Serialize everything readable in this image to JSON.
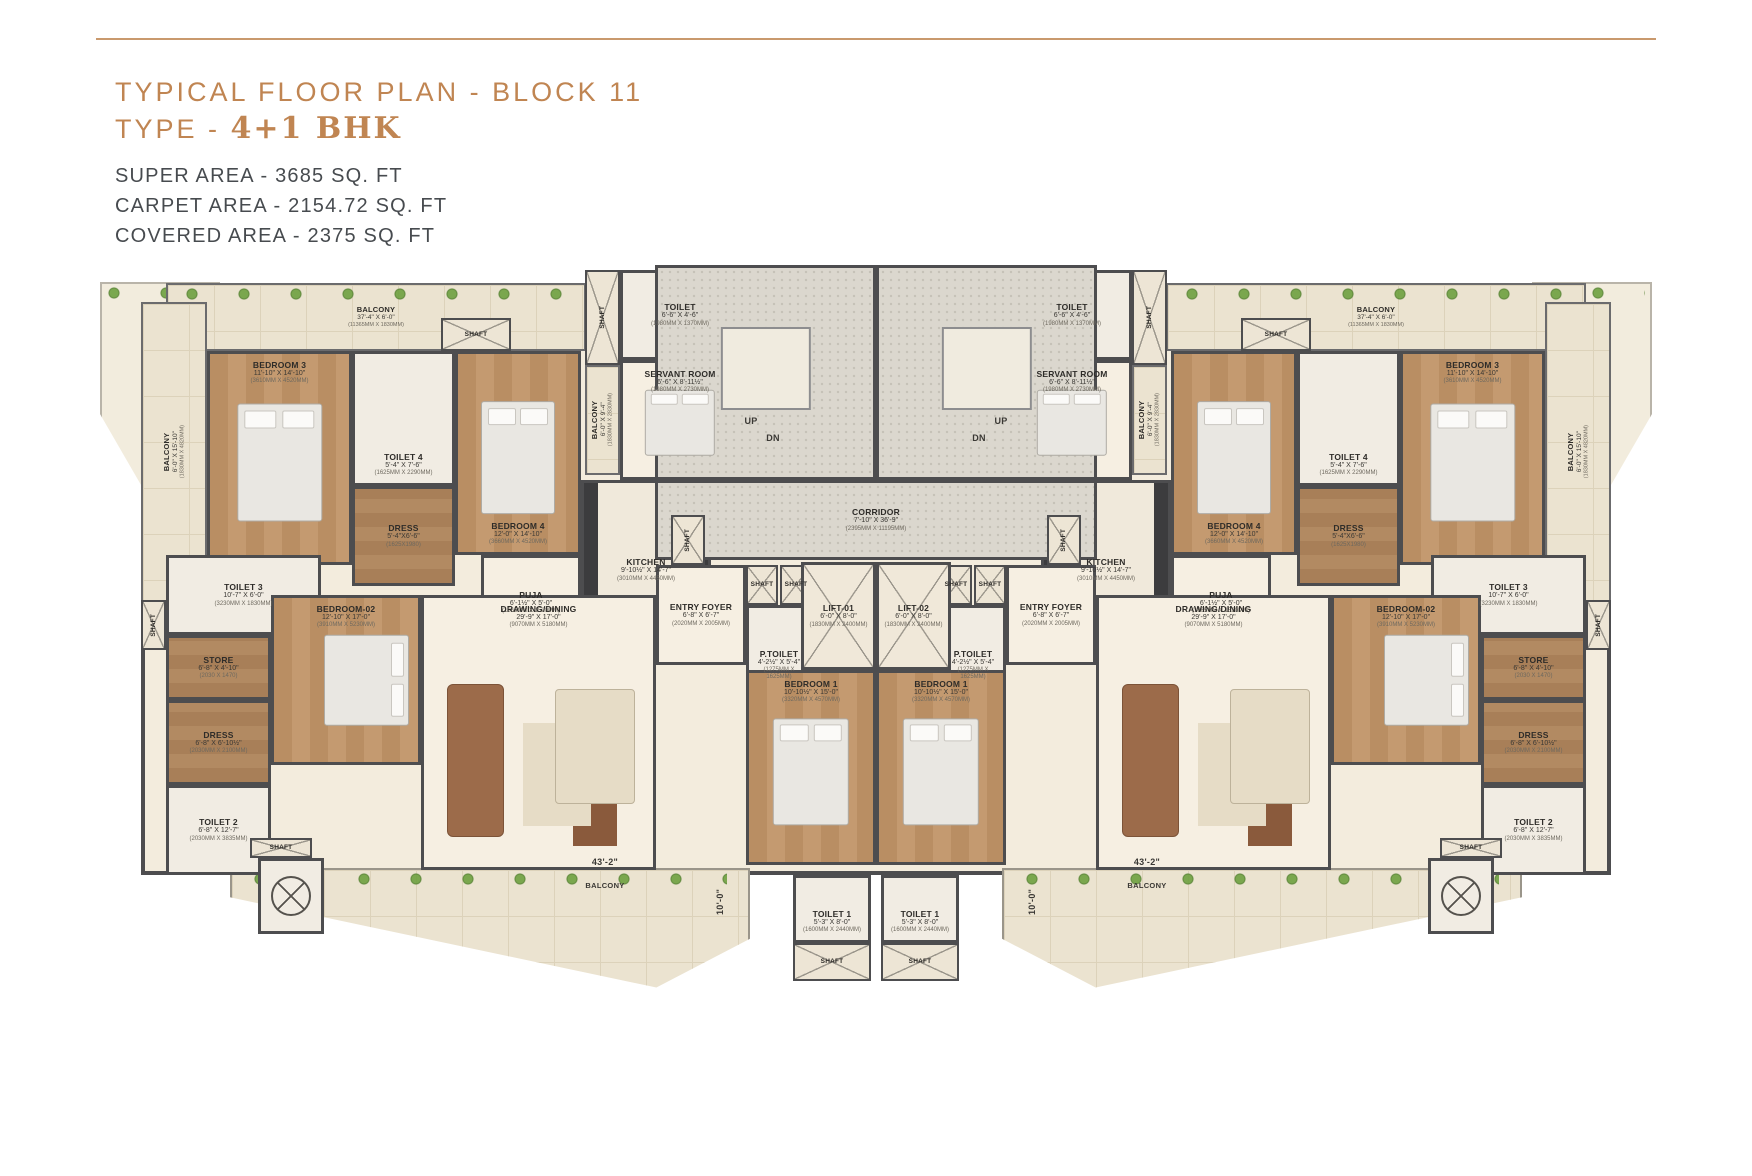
{
  "header": {
    "title": "TYPICAL FLOOR PLAN - BLOCK 11",
    "type_prefix": "TYPE - ",
    "type_value": "4+1 BHK",
    "super_area": "SUPER AREA - 3685 SQ. FT",
    "carpet_area": "CARPET AREA - 2154.72 SQ. FT",
    "covered_area": "COVERED AREA - 2375 SQ. FT",
    "accent_color": "#c08552"
  },
  "plan": {
    "wall_color": "#4d4d4f",
    "mirror_width": 1752,
    "clips": {
      "tl": [
        [
          0,
          0
        ],
        [
          100,
          0
        ],
        [
          100,
          100
        ],
        [
          52,
          100
        ],
        [
          0,
          55
        ]
      ],
      "bb": [
        [
          0,
          0
        ],
        [
          100,
          0
        ],
        [
          100,
          58
        ],
        [
          82,
          98
        ],
        [
          0,
          24
        ]
      ]
    },
    "rooms": [
      {
        "id": "base",
        "cls": "base",
        "x": 141,
        "y": 283,
        "w": 1470,
        "h": 592,
        "wing": "center"
      },
      {
        "id": "terrace",
        "cls": "terrace",
        "x": 100,
        "y": 282,
        "w": 120,
        "h": 240,
        "wing": "both",
        "clip": "tl",
        "furn": "plantrow"
      },
      {
        "id": "balcony-bottom",
        "cls": "bbal",
        "x": 230,
        "y": 868,
        "w": 520,
        "h": 122,
        "wing": "both",
        "clip": "bb",
        "furn": "plantrow"
      },
      {
        "id": "balcony-top",
        "cls": "balc",
        "name": "BALCONY",
        "dim": "37'-4\" X 6'-0\"",
        "mm": "(11365MM X 1830MM)",
        "x": 166,
        "y": 283,
        "w": 420,
        "h": 68,
        "wing": "both",
        "furn": "plantrow"
      },
      {
        "id": "balcony-side",
        "cls": "balc",
        "name": "BALCONY",
        "dim": "6'-0\" X 15'-10\"",
        "mm": "(1830MM X 4820MM)",
        "x": 141,
        "y": 302,
        "w": 66,
        "h": 300,
        "wing": "both",
        "vert": true
      },
      {
        "id": "bedroom-3",
        "cls": "bed",
        "name": "BEDROOM 3",
        "dim": "11'-10\" X 14'-10\"",
        "mm": "(3610MM X 4520MM)",
        "x": 207,
        "y": 351,
        "w": 145,
        "h": 214,
        "wing": "both",
        "lp": "t",
        "furn": "bedv"
      },
      {
        "id": "toilet-4",
        "cls": "bath",
        "name": "TOILET 4",
        "dim": "5'-4\" X 7'-6\"",
        "mm": "(1625MM X 2290MM)",
        "x": 352,
        "y": 351,
        "w": 103,
        "h": 135,
        "wing": "both",
        "lp": "b"
      },
      {
        "id": "dress-4",
        "cls": "wood",
        "name": "DRESS",
        "dim": "5'-4\"X6'-6\"",
        "mm": "(1625X1980)",
        "x": 352,
        "y": 486,
        "w": 103,
        "h": 100,
        "wing": "both"
      },
      {
        "id": "bedroom-4",
        "cls": "bed",
        "name": "BEDROOM 4",
        "dim": "12'-0\" X 14'-10\"",
        "mm": "(3660MM X 4520MM)",
        "x": 455,
        "y": 351,
        "w": 126,
        "h": 204,
        "wing": "both",
        "lp": "b",
        "furn": "bedv"
      },
      {
        "id": "shaft-top",
        "cls": "shaft",
        "name": "SHAFT",
        "x": 441,
        "y": 318,
        "w": 70,
        "h": 33,
        "wing": "both"
      },
      {
        "id": "servant-shaft",
        "cls": "shaft",
        "name": "SHAFT",
        "x": 585,
        "y": 270,
        "w": 35,
        "h": 95,
        "wing": "both",
        "vert": true
      },
      {
        "id": "servant-toilet",
        "cls": "bath",
        "name": "TOILET",
        "dim": "6'-6\" X 4'-6\"",
        "mm": "(1980MM X 1370MM)",
        "x": 620,
        "y": 270,
        "w": 120,
        "h": 90,
        "wing": "both"
      },
      {
        "id": "servant-room",
        "cls": "plain",
        "name": "SERVANT ROOM",
        "dim": "6'-6\" X 8'-11½\"",
        "mm": "(1980MM X 2730MM)",
        "x": 620,
        "y": 360,
        "w": 120,
        "h": 120,
        "wing": "both",
        "lp": "t",
        "furn": "bedv"
      },
      {
        "id": "servant-balcony",
        "cls": "balc",
        "name": "BALCONY",
        "dim": "6'-0\" X 9'-4\"",
        "mm": "(1830MM X 2830MM)",
        "x": 585,
        "y": 365,
        "w": 35,
        "h": 110,
        "wing": "both",
        "vert": true
      },
      {
        "id": "kitchen",
        "cls": "kitchen",
        "name": "KITCHEN",
        "dim": "9'-10½\" X 14'-7\"",
        "mm": "(3010MM X 4450MM)",
        "x": 581,
        "y": 480,
        "w": 130,
        "h": 180,
        "wing": "both"
      },
      {
        "id": "puja",
        "cls": "plain",
        "name": "PUJA",
        "dim": "6'-1½\" X 5'-0\"",
        "mm": "(1865MM X 1520MM)",
        "x": 481,
        "y": 555,
        "w": 100,
        "h": 95,
        "wing": "both"
      },
      {
        "id": "toilet-3",
        "cls": "bath",
        "name": "TOILET 3",
        "dim": "10'-7\" X 6'-0\"",
        "mm": "(3230MM X 1830MM)",
        "x": 166,
        "y": 555,
        "w": 155,
        "h": 80,
        "wing": "both"
      },
      {
        "id": "shaft-side",
        "cls": "shaft",
        "name": "SHAFT",
        "x": 141,
        "y": 600,
        "w": 25,
        "h": 50,
        "wing": "both",
        "vert": true
      },
      {
        "id": "store",
        "cls": "wood",
        "name": "STORE",
        "dim": "6'-8\" X 4'-10\"",
        "mm": "(2030 X 1470)",
        "x": 166,
        "y": 635,
        "w": 105,
        "h": 65,
        "wing": "both"
      },
      {
        "id": "bedroom-02",
        "cls": "bed",
        "name": "BEDROOM-02",
        "dim": "12'-10\" X 17'-0\"",
        "mm": "(3910MM X 5230MM)",
        "x": 271,
        "y": 595,
        "w": 150,
        "h": 170,
        "wing": "both",
        "lp": "t",
        "furn": "bedh"
      },
      {
        "id": "dress-2",
        "cls": "wood",
        "name": "DRESS",
        "dim": "6'-8\" X 6'-10½\"",
        "mm": "(2030MM X 2100MM)",
        "x": 166,
        "y": 700,
        "w": 105,
        "h": 85,
        "wing": "both"
      },
      {
        "id": "toilet-2",
        "cls": "bath",
        "name": "TOILET 2",
        "dim": "6'-8\" X 12'-7\"",
        "mm": "(2030MM X 3835MM)",
        "x": 166,
        "y": 785,
        "w": 105,
        "h": 90,
        "wing": "both"
      },
      {
        "id": "drawing-dining",
        "cls": "plain",
        "name": "DRAWING/DINING",
        "dim": "29'-9\" X 17'-0\"",
        "mm": "(9070MM X 5180MM)",
        "x": 421,
        "y": 595,
        "w": 235,
        "h": 275,
        "wing": "both",
        "lp": "t",
        "furn": "living"
      },
      {
        "id": "entry-foyer",
        "cls": "plain",
        "name": "ENTRY FOYER",
        "dim": "6'-8\" X 6'-7\"",
        "mm": "(2020MM X 2005MM)",
        "x": 656,
        "y": 565,
        "w": 90,
        "h": 100,
        "wing": "both"
      },
      {
        "id": "shaft-f1",
        "cls": "shaft",
        "name": "SHAFT",
        "x": 746,
        "y": 565,
        "w": 32,
        "h": 40,
        "wing": "both"
      },
      {
        "id": "shaft-f2",
        "cls": "shaft",
        "name": "SHAFT",
        "x": 780,
        "y": 565,
        "w": 32,
        "h": 40,
        "wing": "both"
      },
      {
        "id": "p-toilet",
        "cls": "bath",
        "name": "P.TOILET",
        "dim": "4'-2½\" X 5'-4\"",
        "mm": "(1275MM X 1625MM)",
        "x": 746,
        "y": 605,
        "w": 66,
        "h": 85,
        "wing": "both",
        "lp": "b"
      },
      {
        "id": "shaft-washer",
        "cls": "shaft",
        "name": "SHAFT",
        "x": 250,
        "y": 838,
        "w": 62,
        "h": 20,
        "wing": "both"
      },
      {
        "id": "washer",
        "cls": "bath",
        "x": 258,
        "y": 858,
        "w": 66,
        "h": 76,
        "wing": "both",
        "furn": "washeric"
      },
      {
        "id": "stair-hall",
        "cls": "stair",
        "x": 655,
        "y": 265,
        "w": 221,
        "h": 215,
        "wing": "both",
        "furn": "stairvoid"
      },
      {
        "id": "corridor",
        "cls": "corridor",
        "name": "CORRIDOR",
        "dim": "7'-10\" X 36'-9\"",
        "mm": "(2395MM X 11195MM)",
        "x": 655,
        "y": 480,
        "w": 442,
        "h": 80,
        "wing": "center"
      },
      {
        "id": "shaft-corridor",
        "cls": "shaft",
        "name": "SHAFT",
        "x": 671,
        "y": 515,
        "w": 34,
        "h": 50,
        "wing": "both",
        "vert": true
      },
      {
        "id": "lift-01",
        "cls": "lift",
        "name": "LIFT-01",
        "dim": "6'-0\" X 8'-0\"",
        "mm": "(1830MM X 2400MM)",
        "x": 801,
        "y": 562,
        "w": 75,
        "h": 108,
        "wing": "center"
      },
      {
        "id": "lift-02",
        "cls": "lift",
        "name": "LIFT-02",
        "dim": "6'-0\" X 8'-0\"",
        "mm": "(1830MM X 2400MM)",
        "x": 876,
        "y": 562,
        "w": 75,
        "h": 108,
        "wing": "center"
      },
      {
        "id": "bedroom-1",
        "cls": "bed",
        "name": "BEDROOM 1",
        "dim": "10'-10½\" X 15'-0\"",
        "mm": "(3320MM X 4570MM)",
        "x": 746,
        "y": 670,
        "w": 130,
        "h": 195,
        "wing": "both",
        "lp": "t",
        "furn": "bedv"
      },
      {
        "id": "toilet-1",
        "cls": "bath",
        "name": "TOILET 1",
        "dim": "5'-3\" X 8'-0\"",
        "mm": "(1600MM X 2440MM)",
        "x": 793,
        "y": 875,
        "w": 78,
        "h": 68,
        "wing": "both",
        "lp": "b"
      },
      {
        "id": "shaft-bottom",
        "cls": "shaft",
        "name": "SHAFT",
        "x": 793,
        "y": 943,
        "w": 78,
        "h": 38,
        "wing": "both"
      }
    ],
    "notes": [
      {
        "id": "dim-43-2",
        "text": "43'-2\"",
        "x": 560,
        "y": 855,
        "w": 90,
        "h": 14,
        "wing": "both"
      },
      {
        "id": "balcony-bottom-label",
        "text": "BALCONY",
        "cls": "small",
        "x": 560,
        "y": 879,
        "w": 90,
        "h": 12,
        "wing": "both"
      },
      {
        "id": "dim-10-0",
        "text": "10'-0\"",
        "x": 712,
        "y": 872,
        "w": 16,
        "h": 60,
        "wing": "both",
        "vert": true
      },
      {
        "id": "stair-up",
        "text": "UP",
        "x": 736,
        "y": 414,
        "w": 30,
        "h": 14,
        "wing": "both"
      },
      {
        "id": "stair-dn",
        "text": "DN",
        "x": 758,
        "y": 431,
        "w": 30,
        "h": 14,
        "wing": "both"
      }
    ]
  }
}
